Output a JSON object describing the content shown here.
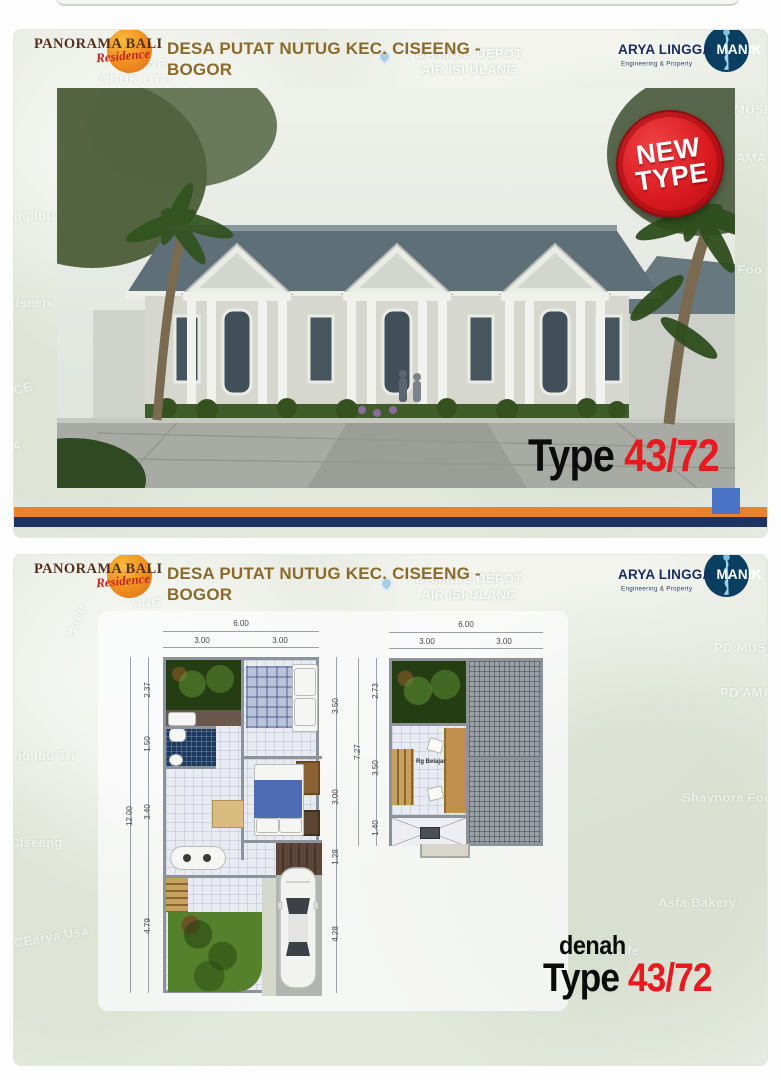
{
  "colors": {
    "title_brown": "#8a6b2b",
    "accent_orange": "#e8822b",
    "accent_navy": "#1d3460",
    "blue_square": "#4a74c6",
    "badge_red": "#d7191e",
    "type_red": "#e8191f",
    "logo_navy": "#1b2c5e"
  },
  "header": {
    "brand_left": {
      "name": "PANORAMA BALI",
      "script": "Residence"
    },
    "brand_right": {
      "line1": "ARYA LINGGA",
      "line2": "MANIK",
      "tagline": "Engineering & Property"
    }
  },
  "panel1": {
    "title_line1": "DESA PUTAT NUTUG KEC. CISEENG -",
    "title_line2": "BOGOR",
    "area_value": "40",
    "area_sup": "+",
    "area_unit": "Ha",
    "badge_line1": "NEW",
    "badge_line2": "TYPE",
    "type_label": "Type",
    "type_value": "43/72",
    "map_labels": [
      "DAMISIU DEPOT",
      "AIR ISI ULANG",
      "Lans Maris",
      "Blu D Snack &",
      "Frozen Food",
      "dang Ibu",
      "Ciseen",
      "NCE",
      "A",
      "MUSL",
      "AMA",
      "a Foo",
      "KUNG",
      "UDUK OTO",
      "Putat"
    ]
  },
  "panel2": {
    "title_line1": "DESA PUTAT NUTUG KEC. CISEENG -",
    "title_line2": "BOGOR",
    "denah_label": "denah",
    "type_label": "Type",
    "type_value": "43/72",
    "map_labels": [
      "DAMISIU DEPOT",
      "AIR ISI ULANG",
      "UNG",
      "PD MUSL",
      "PD AMA",
      "dang Ibu Tri",
      "Ciseeng",
      "Shaynora Foo",
      "Asfa Bakery",
      "Cafe",
      "NCEarya Usa",
      "Putat"
    ],
    "plan_left": {
      "top_total": "6.00",
      "top_segments": [
        "3.00",
        "3.00"
      ],
      "left_total": "12.00",
      "left_segments": [
        "2.37",
        "1.50",
        "3.40",
        "4.79"
      ],
      "right_segments": [
        "3.50",
        "3.00",
        "1.28",
        "4.28"
      ]
    },
    "plan_right": {
      "top_total": "6.00",
      "top_segments": [
        "3.00",
        "3.00"
      ],
      "left_segments": [
        "2.73",
        "3.50",
        "1.40"
      ],
      "side_total": "7.27",
      "room_label": "Rg Belajar"
    }
  }
}
